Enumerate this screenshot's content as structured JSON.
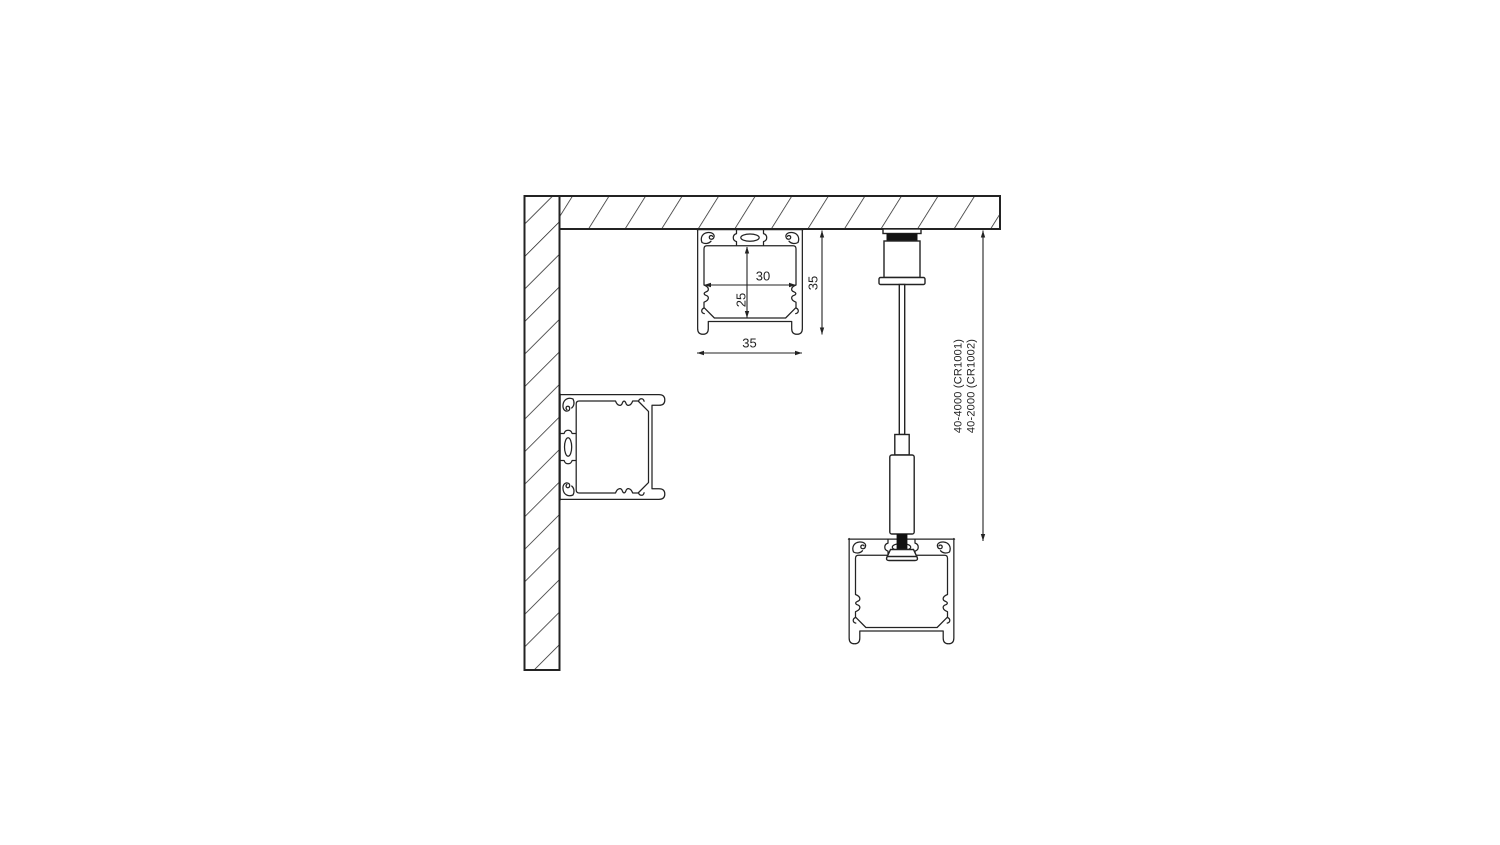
{
  "drawing": {
    "background": "#ffffff",
    "line_color": "#232323",
    "fill_black": "#111111",
    "labels": {
      "inner_width": "30",
      "inner_height": "25",
      "profile_height": "35",
      "profile_width": "35",
      "suspension_code_1": "40-4000 (CR1001)",
      "suspension_code_2": "40-2000 (CR1002)"
    }
  }
}
